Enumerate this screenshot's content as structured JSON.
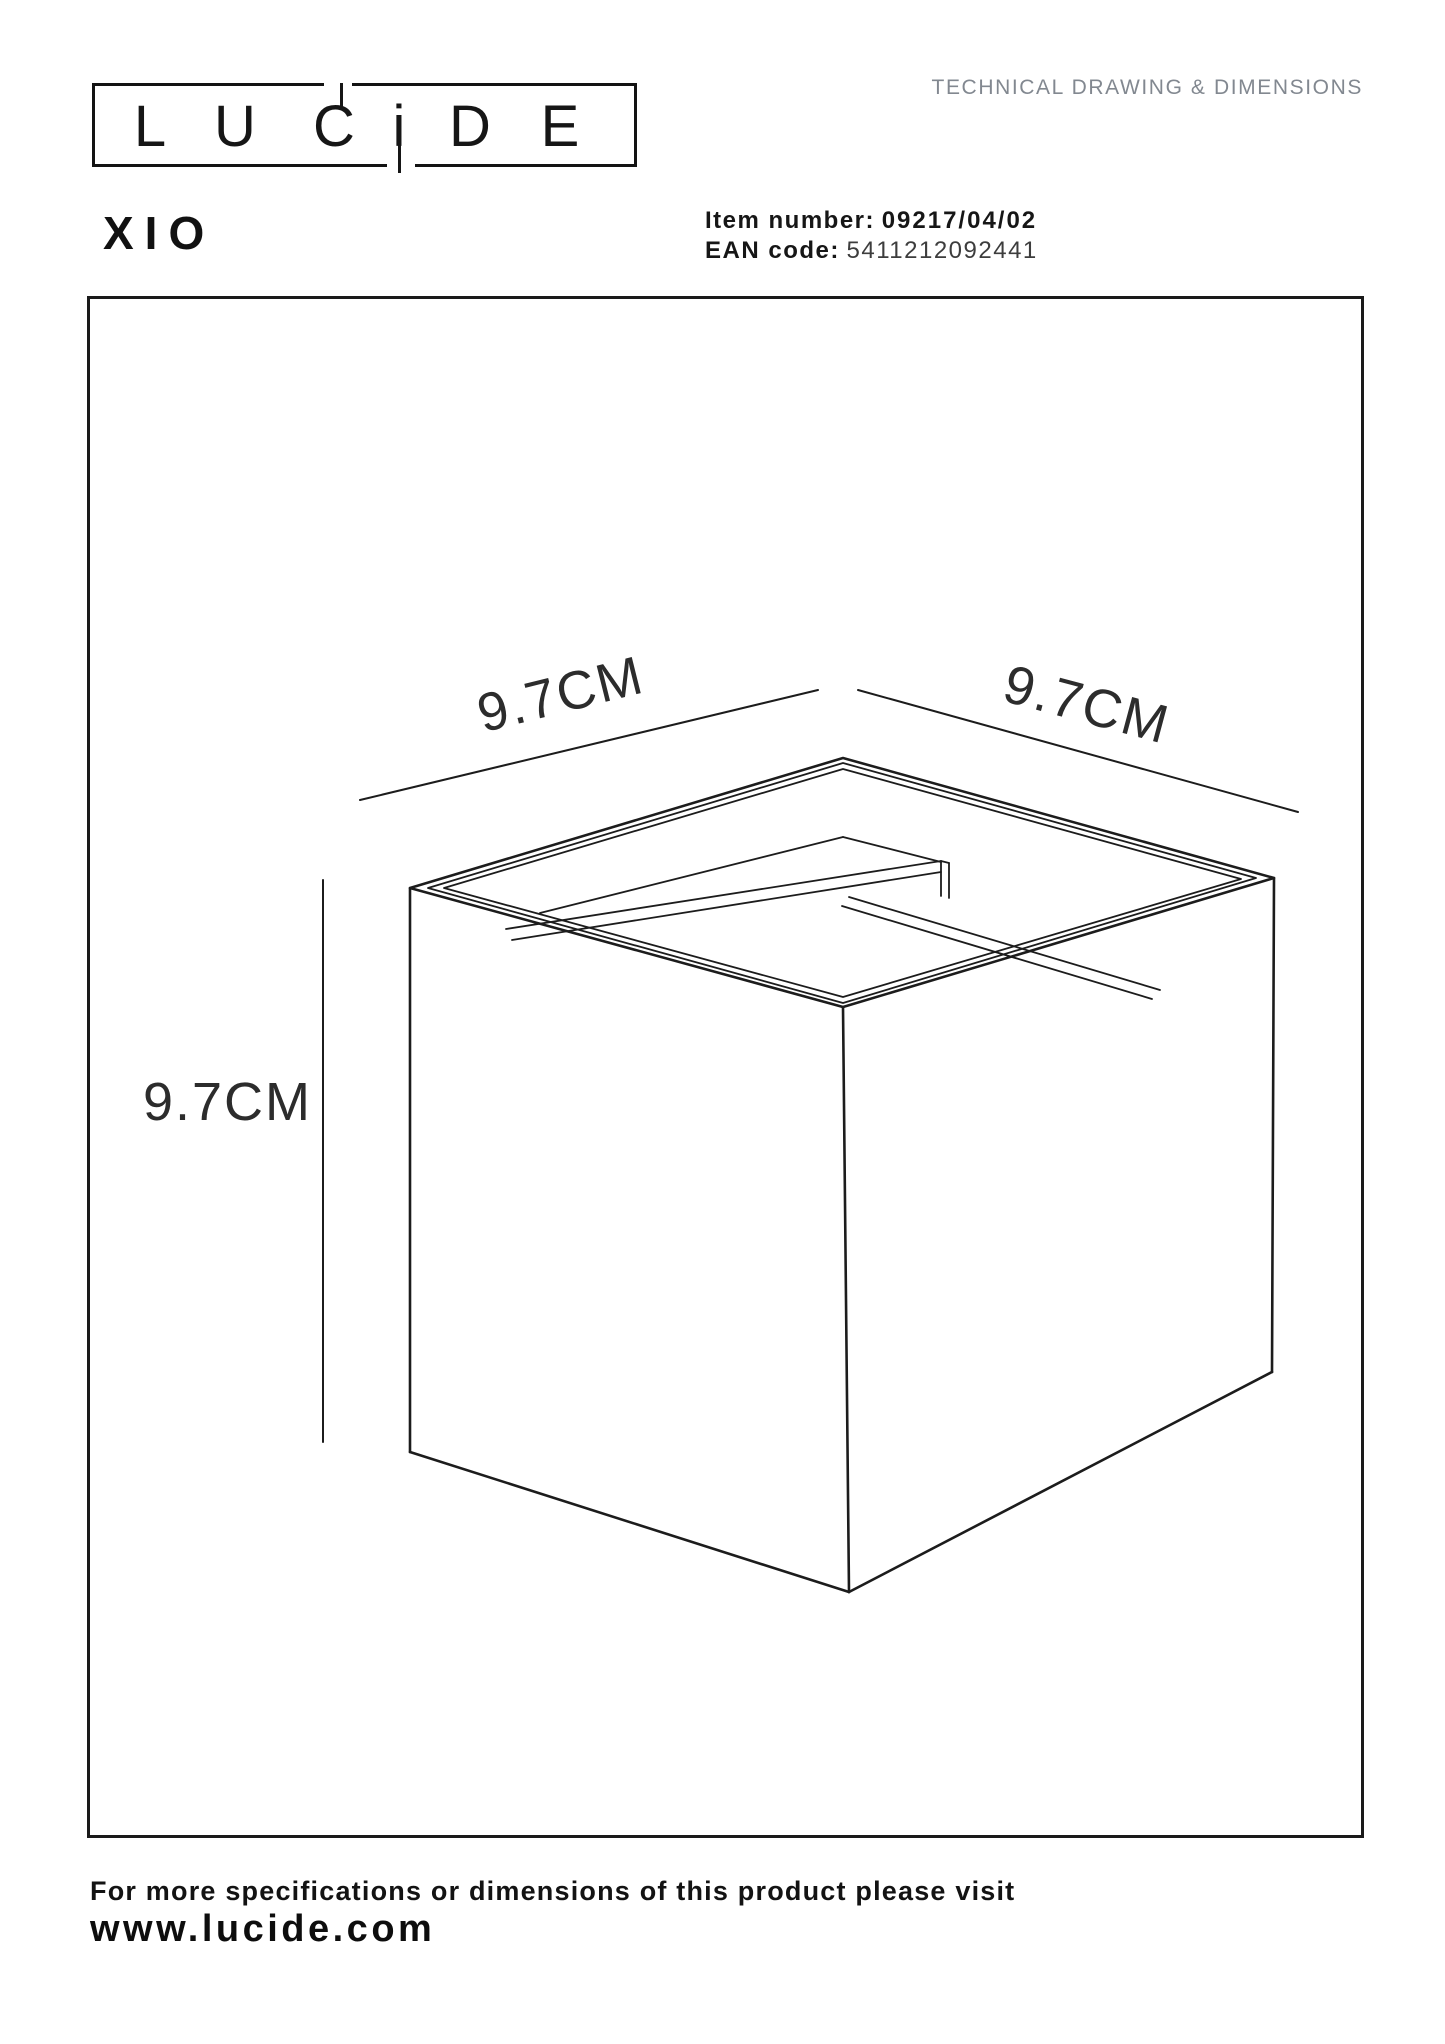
{
  "header": {
    "logo_text": "LUCIDE",
    "logo_letters": [
      "L",
      "U",
      "C",
      "i",
      "D",
      "E"
    ],
    "doc_type": "TECHNICAL DRAWING & DIMENSIONS"
  },
  "product": {
    "name": "XIO",
    "item_number_label": "Item number:",
    "item_number": "09217/04/02",
    "ean_label": "EAN code:",
    "ean": "5411212092441"
  },
  "drawing": {
    "type": "isometric-technical-drawing",
    "object": "cube wall light, open top with inner plate and divider",
    "dim_width": "9.7CM",
    "dim_depth": "9.7CM",
    "dim_height": "9.7CM"
  },
  "footer": {
    "note": "For more specifications or dimensions of this product please visit",
    "website": "www.lucide.com"
  },
  "colors": {
    "line": "#1c1c1c",
    "muted_header": "#828890",
    "background": "#ffffff"
  }
}
